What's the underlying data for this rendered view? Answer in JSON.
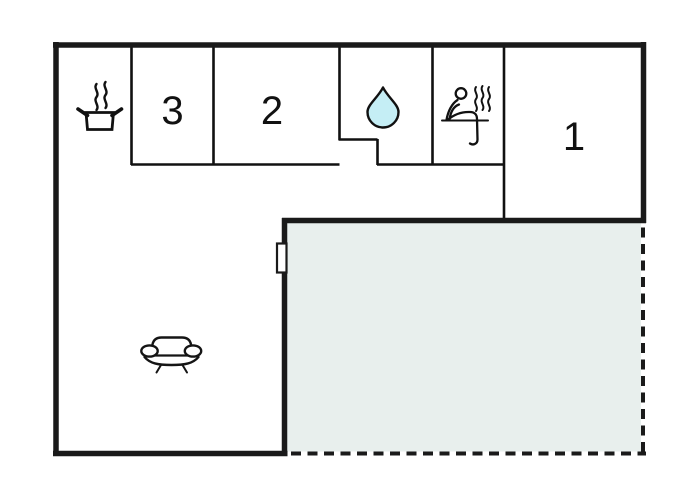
{
  "floor_plan": {
    "room_labels": {
      "bedroom_3": "3",
      "bedroom_2": "2",
      "bedroom_1": "1"
    },
    "icons": {
      "kitchen": "cooking-pot-icon",
      "bathroom": "water-drop-icon",
      "sauna": "sauna-person-icon",
      "living_room": "sofa-icon"
    },
    "colors": {
      "wall": "#1a1a1a",
      "thin_wall": "#111111",
      "terrace_fill": "#e8efed",
      "drop_fill": "#c5eef5",
      "background": "#ffffff"
    }
  }
}
